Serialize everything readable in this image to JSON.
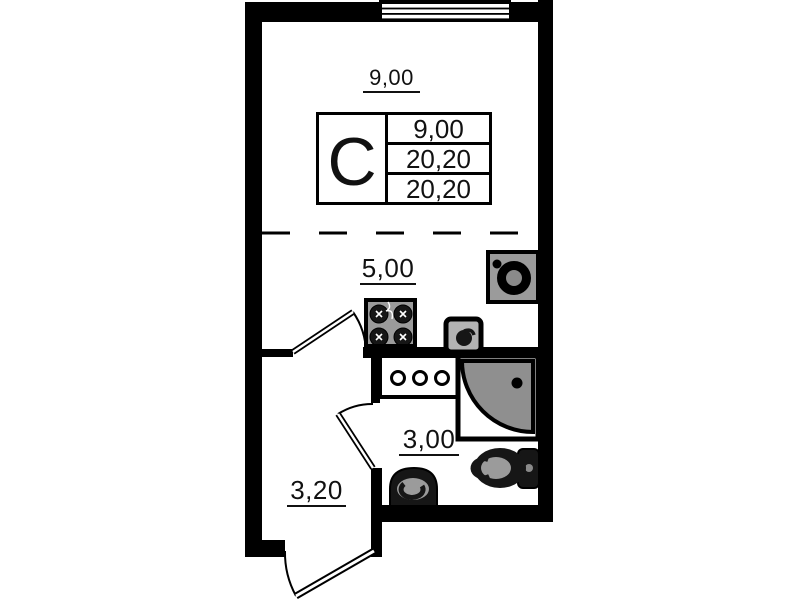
{
  "plan": {
    "type": "studio-apartment-floor-plan",
    "labels": {
      "room_area": "9,00",
      "kitchen_area": "5,00",
      "bathroom_area": "3,00",
      "hall_area": "3,20"
    },
    "stamp": {
      "letter": "С",
      "values": [
        "9,00",
        "20,20",
        "20,20"
      ]
    },
    "fixtures": [
      {
        "icon": "stove-icon",
        "zone": "kitchen"
      },
      {
        "icon": "kitchen-sink-icon",
        "zone": "kitchen"
      },
      {
        "icon": "washing-machine-icon",
        "zone": "kitchen"
      },
      {
        "icon": "shower-cabin-icon",
        "zone": "bathroom"
      },
      {
        "icon": "counter-with-holes-icon",
        "zone": "bathroom"
      },
      {
        "icon": "toilet-icon",
        "zone": "bathroom"
      },
      {
        "icon": "washbasin-icon",
        "zone": "bathroom"
      },
      {
        "icon": "window-icon",
        "zone": "room"
      },
      {
        "icon": "interior-door-icon",
        "zone": "hall"
      },
      {
        "icon": "bathroom-door-icon",
        "zone": "hall"
      },
      {
        "icon": "entry-door-icon",
        "zone": "hall"
      }
    ],
    "colors": {
      "walls": "#000000",
      "fixture_gray": "#9b9b9b",
      "shower_tray": "#8f8f8f",
      "background": "#ffffff",
      "text": "#111111"
    }
  }
}
